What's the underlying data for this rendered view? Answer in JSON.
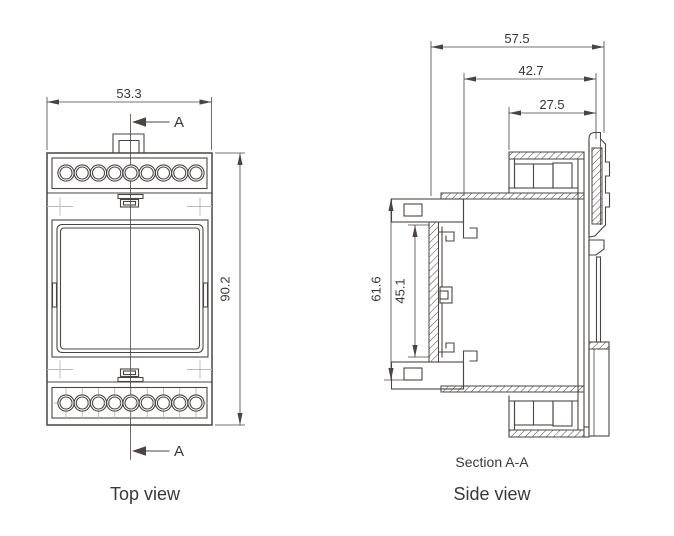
{
  "drawing": {
    "background": "#ffffff",
    "line_color": "#4a4542",
    "light_line_color": "#bcb7b1",
    "text_color": "#3b3835"
  },
  "top_view": {
    "title": "Top view",
    "section_marker": "A",
    "terminals_per_row": 9,
    "width_mm": "53.3",
    "height_mm": "90.2"
  },
  "side_view": {
    "title": "Side view",
    "section_label": "Section A-A",
    "overall_depth_mm": "57.5",
    "rail_to_front_mm": "42.7",
    "terminal_depth_mm": "27.5",
    "front_height_mm": "61.6",
    "window_height_mm": "45.1"
  }
}
